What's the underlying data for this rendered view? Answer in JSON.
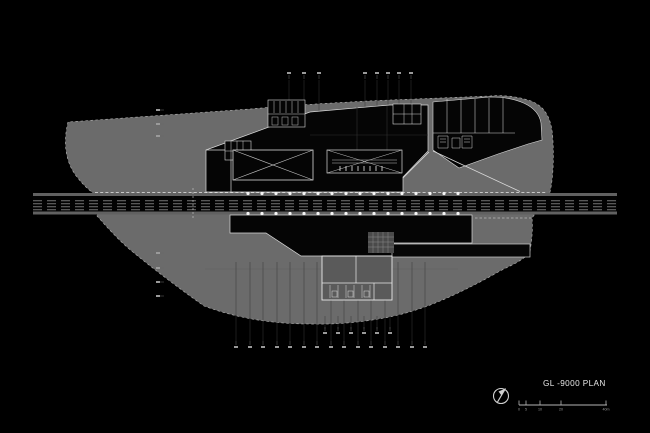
{
  "canvas": {
    "background": "#000000"
  },
  "title_block": {
    "plan_title": "GL -9000 PLAN",
    "north_arrow_icon": "north-arrow-compass",
    "scale_bar": {
      "unit_labels": [
        "0",
        "5",
        "10",
        "20",
        "40m"
      ],
      "tick_x": [
        519,
        526,
        540,
        561,
        606
      ],
      "baseline_y": 405
    }
  },
  "colors": {
    "background": "#000000",
    "site_fill": "#6b6b6b",
    "site_edge_dash": "#b8b8b8",
    "building_fill": "#050505",
    "wall_white": "#dcdcdc",
    "track_gray": "#747474",
    "column_dot": "#f5f5f5",
    "grid_mark": "#9a9a9a",
    "leader_line": "#3a3a3a",
    "title_text": "#e8e8e8",
    "scale_text": "#9a9a9a"
  },
  "drawing": {
    "tracks": {
      "count": 4,
      "ys": [
        200.7,
        203.7,
        206.7,
        209.7
      ],
      "x1": 33,
      "x2": 617,
      "dash": "9 5"
    },
    "rail_strips": {
      "top_y": 193,
      "bottom_y": 211.5,
      "height": 3
    },
    "platform_columns": {
      "rows": [
        193.5,
        213.5
      ],
      "x_start": 248,
      "x_step": 14,
      "count": 16
    },
    "grid_marks": {
      "top_a": {
        "axis": "x",
        "y": 73,
        "x": [
          289,
          304,
          319
        ],
        "tick": "down"
      },
      "top_b": {
        "axis": "x",
        "y": 73,
        "x": [
          365,
          377,
          388,
          399,
          411
        ],
        "tick": "down"
      },
      "left_upper": {
        "axis": "y",
        "x": 158,
        "y": [
          110,
          124,
          136
        ],
        "tick": "right"
      },
      "left_lower": {
        "axis": "y",
        "x": 158,
        "y": [
          253,
          268,
          282,
          296
        ],
        "tick": "right"
      },
      "bottom_a": {
        "axis": "x",
        "y": 333,
        "x": [
          325,
          338,
          351,
          364,
          377,
          390
        ],
        "tick": "up"
      },
      "bottom_b": {
        "axis": "x",
        "y": 347,
        "x": [
          236,
          250,
          263,
          277,
          290,
          304,
          317,
          331,
          344,
          358,
          371,
          385,
          398,
          412,
          425
        ],
        "tick": "up"
      }
    },
    "leaders": {
      "top_a": {
        "from": 80,
        "to": 152
      },
      "top_b": {
        "from": 80,
        "to": 160
      },
      "bottom_a": {
        "from": 329,
        "to": 316
      },
      "bottom_b": {
        "from": 341,
        "to": 262
      }
    }
  }
}
